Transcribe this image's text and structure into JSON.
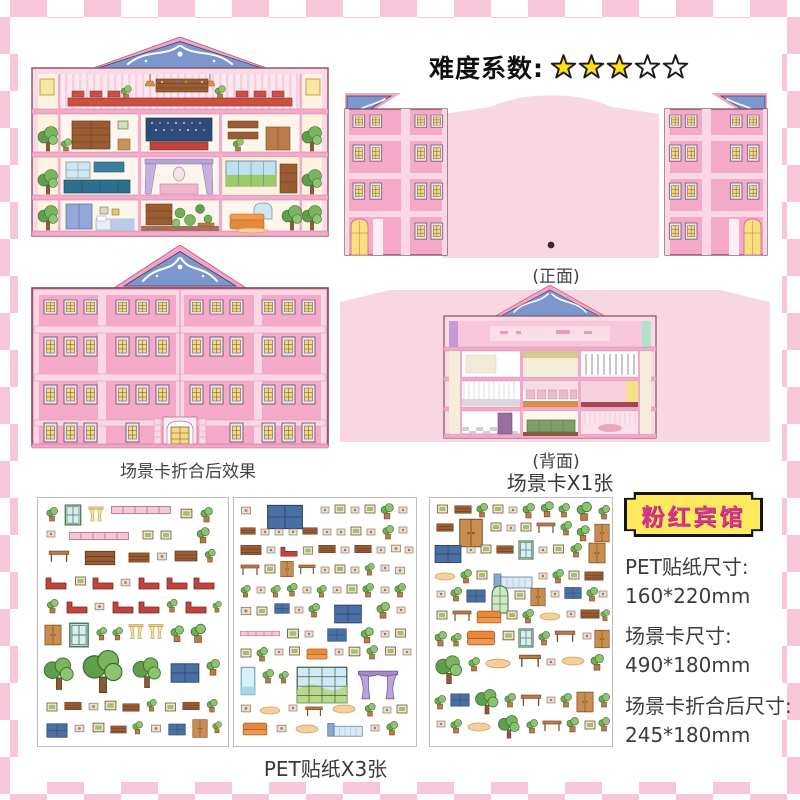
{
  "difficulty": {
    "label": "难度系数:",
    "stars_filled": 3,
    "stars_total": 5
  },
  "labels": {
    "front": "(正面)",
    "back": "(背面)",
    "folded_effect": "场景卡折合后效果",
    "scene_card_count": "场景卡X1张",
    "sticker_sheet_count": "PET贴纸X3张"
  },
  "badge": {
    "title": "粉红宾馆"
  },
  "specs": [
    {
      "label": "PET贴纸尺寸:",
      "value": "160*220mm"
    },
    {
      "label": "场景卡尺寸:",
      "value": "490*180mm"
    },
    {
      "label": "场景卡折合后尺寸:",
      "value": "245*180mm"
    }
  ],
  "colors": {
    "border_pink": "#f8c6d9",
    "panel_pink": "#f8d7e3",
    "building_pink": "#f5a9c8",
    "building_light_pink": "#fbd6e5",
    "roof_blue": "#7b97cd",
    "window_yellow": "#f7d978",
    "star_yellow": "#ffdf1b",
    "badge_yellow": "#ffe95c",
    "badge_text": "#d6358f"
  }
}
